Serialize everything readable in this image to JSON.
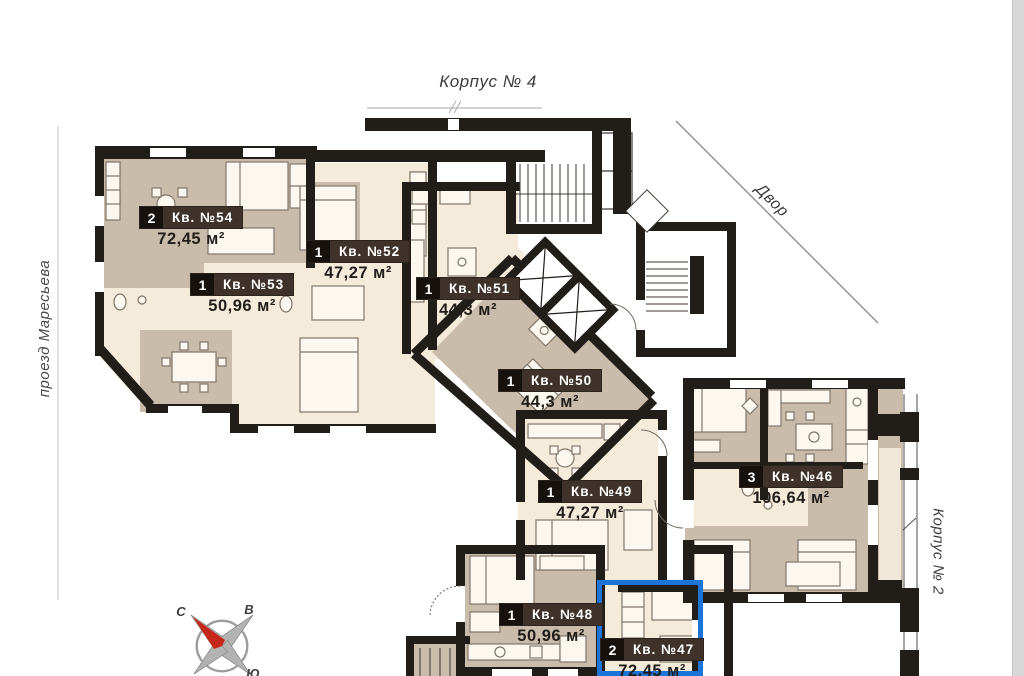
{
  "scene": {
    "building_top_label": "Корпус № 4",
    "street_label": "проезд Маресьева",
    "courtyard_label": "Двор",
    "adjacent_building_label": "Корпус № 2"
  },
  "compass": {
    "north": "С",
    "east": "В",
    "south": "Ю",
    "west": "З"
  },
  "apartments": [
    {
      "number": "Кв. №54",
      "rooms": "2",
      "area": "72,45 м²"
    },
    {
      "number": "Кв. №53",
      "rooms": "1",
      "area": "50,96 м²"
    },
    {
      "number": "Кв. №52",
      "rooms": "1",
      "area": "47,27 м²"
    },
    {
      "number": "Кв. №51",
      "rooms": "1",
      "area": "44,3 м²"
    },
    {
      "number": "Кв. №50",
      "rooms": "1",
      "area": "44,3 м²"
    },
    {
      "number": "Кв. №49",
      "rooms": "1",
      "area": "47,27 м²"
    },
    {
      "number": "Кв. №48",
      "rooms": "1",
      "area": "50,96 м²"
    },
    {
      "number": "Кв. №47",
      "rooms": "2",
      "area": "72,45 м²",
      "highlighted": true
    },
    {
      "number": "Кв. №46",
      "rooms": "3",
      "area": "106,64 м²"
    }
  ],
  "highlight": {
    "apartment": "Кв. №47",
    "color": "#1b74d6"
  },
  "colors": {
    "wall": "#211d19",
    "room_tan": "#c9bcab",
    "room_cream": "#f4ebdb",
    "plate_bg": "#3e322a",
    "badge_bg": "#16110d",
    "compass_red": "#c6271b"
  }
}
